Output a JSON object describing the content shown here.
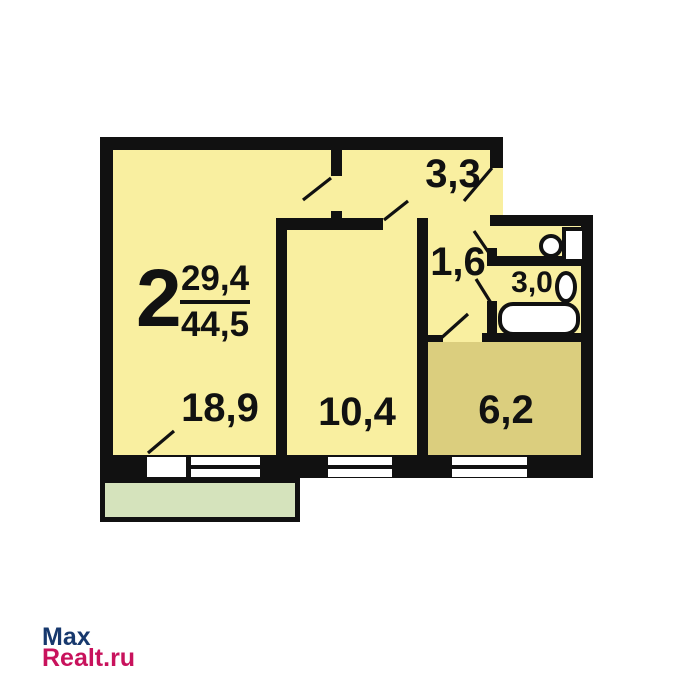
{
  "plan": {
    "unit_info": {
      "rooms_count": "2",
      "living_area": "29,4",
      "total_area": "44,5"
    },
    "rooms": {
      "living_room": {
        "area": "18,9"
      },
      "bedroom": {
        "area": "10,4"
      },
      "kitchen": {
        "area": "6,2"
      },
      "hallway": {
        "area": "3,3"
      },
      "corridor": {
        "area": "1,6"
      },
      "bathroom": {
        "area": "3,0"
      }
    },
    "fixtures": [
      "toilet",
      "sink",
      "bathtub"
    ],
    "colors": {
      "wall": "#111111",
      "room_fill": "#f9efa0",
      "kitchen_fill": "#dbce7e",
      "balcony_fill": "#d5e3bc",
      "window_fill": "#ffffff"
    }
  },
  "watermark": {
    "line1": "Max",
    "line2": "Realt.ru",
    "line1_color": "#17386d",
    "line2_color": "#c8125c"
  }
}
